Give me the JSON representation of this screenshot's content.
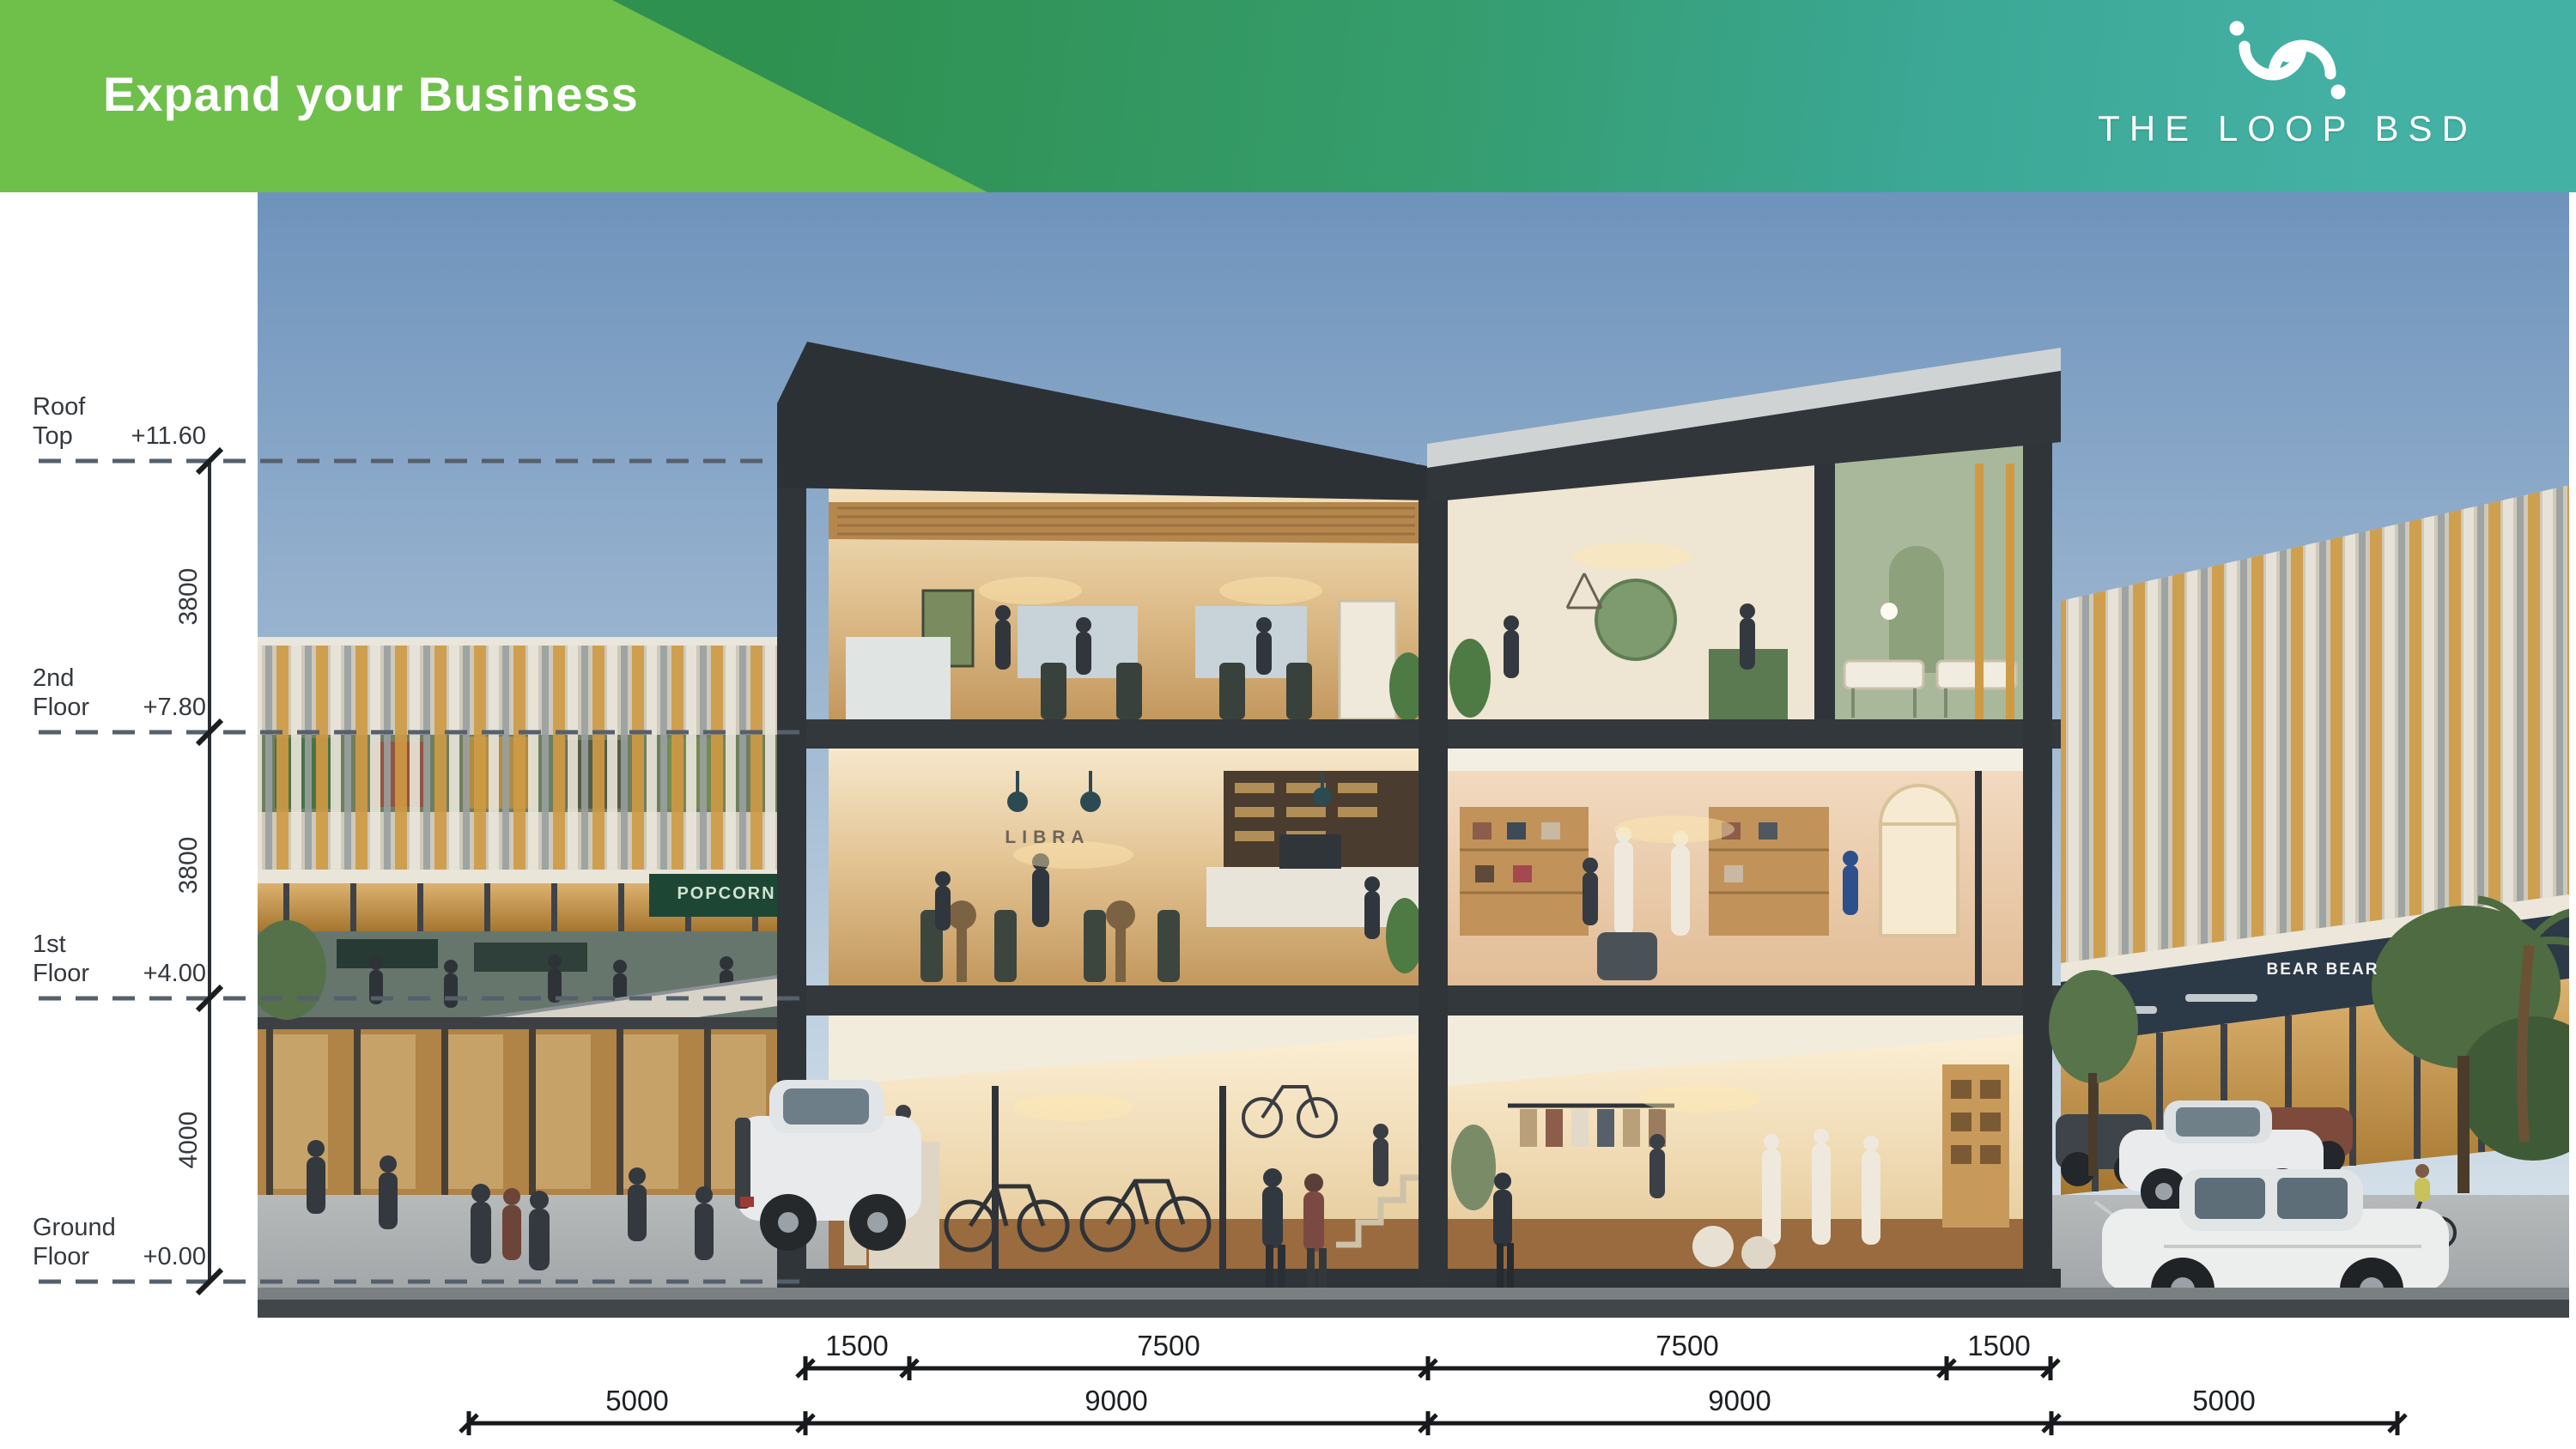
{
  "header": {
    "title": "Expand your Business",
    "brand_name": "THE LOOP BSD",
    "colors": {
      "light_green": "#6fbf4b",
      "dark_green": "#2f9150",
      "teal": "#44b1a5"
    }
  },
  "levels": [
    {
      "line1": "Roof",
      "line2": "Top",
      "elevation": "+11.60"
    },
    {
      "line1": "2nd",
      "line2": "Floor",
      "elevation": "+7.80"
    },
    {
      "line1": "1st",
      "line2": "Floor",
      "elevation": "+4.00"
    },
    {
      "line1": "Ground",
      "line2": "Floor",
      "elevation": "+0.00"
    }
  ],
  "vertical_dimensions": [
    {
      "value": "3800"
    },
    {
      "value": "3800"
    },
    {
      "value": "4000"
    }
  ],
  "horizontal_dimensions": {
    "inner": [
      "1500",
      "7500",
      "7500",
      "1500"
    ],
    "outer": [
      "5000",
      "9000",
      "9000",
      "5000"
    ]
  },
  "signage": {
    "cafe": "LIBRA",
    "popcorn": "POPCORN",
    "bear": "BEAR BEAR"
  }
}
